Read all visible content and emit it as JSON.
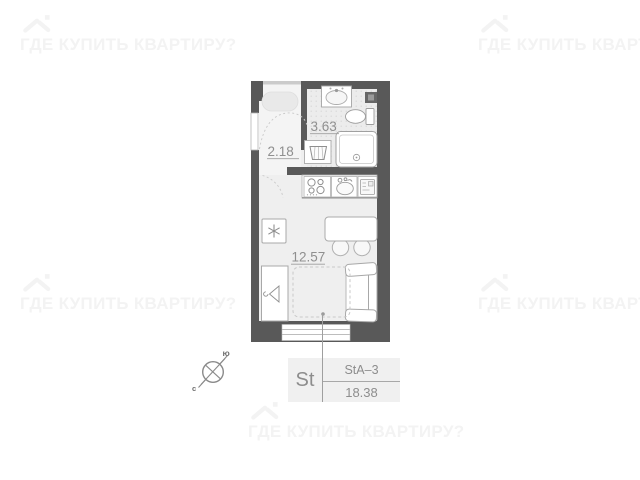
{
  "watermark": {
    "text": "ГДЕ КУПИТЬ КВАРТИРУ?"
  },
  "rooms": {
    "hall": {
      "area": "2.18"
    },
    "bathroom": {
      "area": "3.63"
    },
    "living": {
      "area": "12.57"
    }
  },
  "spec": {
    "type": "St",
    "layout_code": "StA–3",
    "total_area": "18.38"
  },
  "compass": {
    "south": "ю",
    "north": "с"
  },
  "fixture_icons": [
    "house-roof-icon",
    "bathtub",
    "wash-basin",
    "toilet",
    "shower-cabin",
    "vent-shaft",
    "laundry-basket",
    "hob-burners",
    "kitchen-sink",
    "oven-unit",
    "fridge-snowflake",
    "dining-table",
    "chair",
    "wardrobe-hanger",
    "sofa",
    "bed-dashed-outline",
    "window",
    "entry-door-leaf",
    "door-swing-arc",
    "compass-cross"
  ],
  "colors": {
    "wall": "#595959",
    "floor_living": "#efefef",
    "floor_bath": "#ececec",
    "floor_hall": "#f4f4f4",
    "fixture_stroke": "#a8a8a8",
    "label_text": "#8f8f8f",
    "watermark": "#f3f3f3",
    "leader_line": "#9f9f9f",
    "spec_box_bg": "#f0f0f0"
  }
}
